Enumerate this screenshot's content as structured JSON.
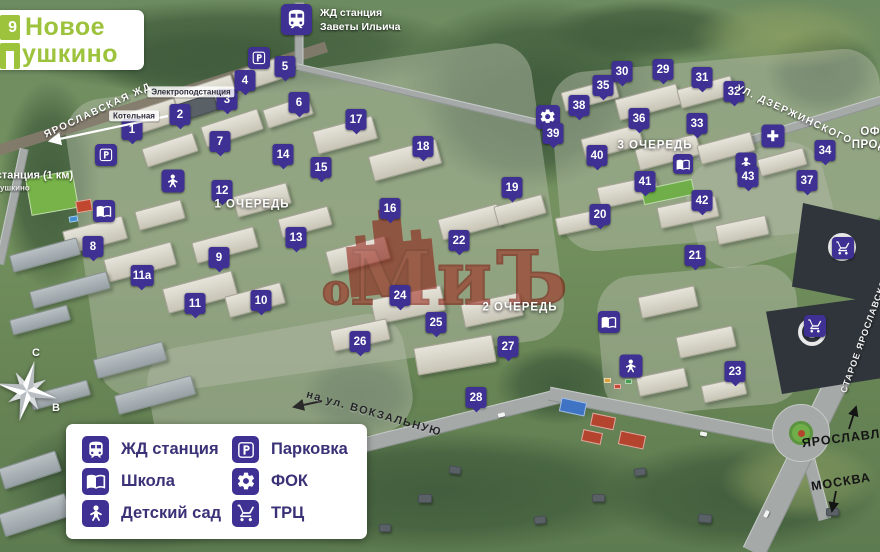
{
  "logo": {
    "badge_number": "9",
    "line1": "Новое",
    "line2": "ушкино"
  },
  "station_callout": {
    "line1": "ЖД станция",
    "line2": "Заветы Ильича"
  },
  "watermark": {
    "text_small": "о",
    "text_big": "МиЪ"
  },
  "compass": {
    "north": "С",
    "east": "В"
  },
  "colors": {
    "marker_purple": "#3e3193",
    "logo_green": "#9dc23c",
    "watermark_red": "#8c150b"
  },
  "legend": {
    "items": [
      {
        "icon": "train",
        "label": "ЖД станция"
      },
      {
        "icon": "book",
        "label": "Школа"
      },
      {
        "icon": "ginger",
        "label": "Детский сад"
      },
      {
        "icon": "parking",
        "label": "Парковка"
      },
      {
        "icon": "gear",
        "label": "ФОК"
      },
      {
        "icon": "cart",
        "label": "ТРЦ"
      }
    ]
  },
  "map": {
    "markers": [
      {
        "n": "1",
        "x": 132,
        "y": 132
      },
      {
        "n": "2",
        "x": 180,
        "y": 117
      },
      {
        "n": "3",
        "x": 227,
        "y": 102
      },
      {
        "n": "4",
        "x": 245,
        "y": 83
      },
      {
        "n": "5",
        "x": 285,
        "y": 69
      },
      {
        "n": "6",
        "x": 299,
        "y": 105
      },
      {
        "n": "7",
        "x": 220,
        "y": 144
      },
      {
        "n": "8",
        "x": 93,
        "y": 249
      },
      {
        "n": "9",
        "x": 219,
        "y": 260
      },
      {
        "n": "10",
        "x": 261,
        "y": 303
      },
      {
        "n": "11",
        "x": 195,
        "y": 306
      },
      {
        "n": "11а",
        "x": 142,
        "y": 278
      },
      {
        "n": "12",
        "x": 222,
        "y": 193
      },
      {
        "n": "13",
        "x": 296,
        "y": 240
      },
      {
        "n": "14",
        "x": 283,
        "y": 157
      },
      {
        "n": "15",
        "x": 321,
        "y": 170
      },
      {
        "n": "16",
        "x": 390,
        "y": 211
      },
      {
        "n": "17",
        "x": 356,
        "y": 122
      },
      {
        "n": "18",
        "x": 423,
        "y": 149
      },
      {
        "n": "19",
        "x": 512,
        "y": 190
      },
      {
        "n": "20",
        "x": 600,
        "y": 217
      },
      {
        "n": "21",
        "x": 695,
        "y": 258
      },
      {
        "n": "22",
        "x": 459,
        "y": 243
      },
      {
        "n": "23",
        "x": 735,
        "y": 374
      },
      {
        "n": "24",
        "x": 400,
        "y": 298
      },
      {
        "n": "25",
        "x": 436,
        "y": 325
      },
      {
        "n": "26",
        "x": 360,
        "y": 344
      },
      {
        "n": "27",
        "x": 508,
        "y": 349
      },
      {
        "n": "28",
        "x": 476,
        "y": 400
      },
      {
        "n": "29",
        "x": 663,
        "y": 72
      },
      {
        "n": "30",
        "x": 622,
        "y": 74
      },
      {
        "n": "31",
        "x": 702,
        "y": 80
      },
      {
        "n": "32",
        "x": 734,
        "y": 94
      },
      {
        "n": "33",
        "x": 697,
        "y": 126
      },
      {
        "n": "34",
        "x": 825,
        "y": 153
      },
      {
        "n": "35",
        "x": 603,
        "y": 88
      },
      {
        "n": "36",
        "x": 639,
        "y": 121
      },
      {
        "n": "37",
        "x": 807,
        "y": 183
      },
      {
        "n": "38",
        "x": 579,
        "y": 108
      },
      {
        "n": "39",
        "x": 553,
        "y": 136
      },
      {
        "n": "40",
        "x": 597,
        "y": 158
      },
      {
        "n": "41",
        "x": 645,
        "y": 184
      },
      {
        "n": "42",
        "x": 702,
        "y": 203
      },
      {
        "n": "43",
        "x": 748,
        "y": 179
      }
    ],
    "icons": [
      {
        "type": "parking",
        "x": 259,
        "y": 58,
        "s": 22
      },
      {
        "type": "parking",
        "x": 106,
        "y": 155,
        "s": 22
      },
      {
        "type": "book",
        "x": 104,
        "y": 211,
        "s": 22
      },
      {
        "type": "ginger",
        "x": 173,
        "y": 181,
        "s": 23
      },
      {
        "type": "gear",
        "x": 548,
        "y": 117,
        "s": 24
      },
      {
        "type": "book",
        "x": 683,
        "y": 164,
        "s": 20
      },
      {
        "type": "ginger",
        "x": 746,
        "y": 163,
        "s": 21
      },
      {
        "type": "plus",
        "x": 773,
        "y": 136,
        "s": 23
      },
      {
        "type": "book",
        "x": 609,
        "y": 322,
        "s": 22
      },
      {
        "type": "ginger",
        "x": 631,
        "y": 366,
        "s": 23
      },
      {
        "type": "cart",
        "x": 843,
        "y": 248,
        "s": 22
      },
      {
        "type": "cart",
        "x": 815,
        "y": 326,
        "s": 22
      }
    ],
    "labels": [
      {
        "text": "ЯРОСЛАВСКАЯ ЖД",
        "x": 98,
        "y": 111,
        "rot": -25,
        "cls": "street-white"
      },
      {
        "text": "Электроподстанция",
        "x": 191,
        "y": 92,
        "rot": 0,
        "cls": "badge"
      },
      {
        "text": "Котельная",
        "x": 134,
        "y": 116,
        "rot": 0,
        "cls": "badge"
      },
      {
        "text": "ЖД станция (1 км)",
        "x": 24,
        "y": 176,
        "rot": 0,
        "cls": "white-bold"
      },
      {
        "text": "Пушкино",
        "x": 12,
        "y": 188,
        "rot": 0,
        "cls": "white-small"
      },
      {
        "text": "1 ОЧЕРЕДЬ",
        "x": 252,
        "y": 205,
        "rot": 0,
        "cls": "phase"
      },
      {
        "text": "2 ОЧЕРЕДЬ",
        "x": 520,
        "y": 308,
        "rot": 0,
        "cls": "phase"
      },
      {
        "text": "3 ОЧЕРЕДЬ",
        "x": 655,
        "y": 146,
        "rot": 0,
        "cls": "phase"
      },
      {
        "text": "УЛ. ДЗЕРЖИНСКОГО",
        "x": 794,
        "y": 115,
        "rot": 25,
        "cls": "street-white"
      },
      {
        "text": "ОФИС\nПРОДАЖ",
        "x": 879,
        "y": 139,
        "rot": 0,
        "cls": "white-bold pre"
      },
      {
        "text": "на ул. ВОКЗАЛЬНУЮ",
        "x": 374,
        "y": 414,
        "rot": 16,
        "cls": "street-dark"
      },
      {
        "text": "СТАРОЕ ЯРОСЛАВСКОЕ",
        "x": 865,
        "y": 333,
        "rot": -70,
        "cls": "street-white-sm"
      },
      {
        "text": "ЯРОСЛАВЛЬ",
        "x": 846,
        "y": 438,
        "rot": -7,
        "cls": "dir-dark"
      },
      {
        "text": "МОСКВА",
        "x": 841,
        "y": 482,
        "rot": -9,
        "cls": "dir-dark"
      }
    ],
    "arrows": [
      {
        "x1": 168,
        "y1": 116,
        "x2": 50,
        "y2": 141,
        "color": "#ffffff",
        "w": 2.2
      },
      {
        "x1": 322,
        "y1": 401,
        "x2": 294,
        "y2": 407,
        "color": "#2a2a2a",
        "w": 2
      },
      {
        "x1": 849,
        "y1": 429,
        "x2": 856,
        "y2": 407,
        "color": "#141414",
        "w": 1.8
      },
      {
        "x1": 836,
        "y1": 491,
        "x2": 832,
        "y2": 511,
        "color": "#141414",
        "w": 1.8
      }
    ]
  }
}
